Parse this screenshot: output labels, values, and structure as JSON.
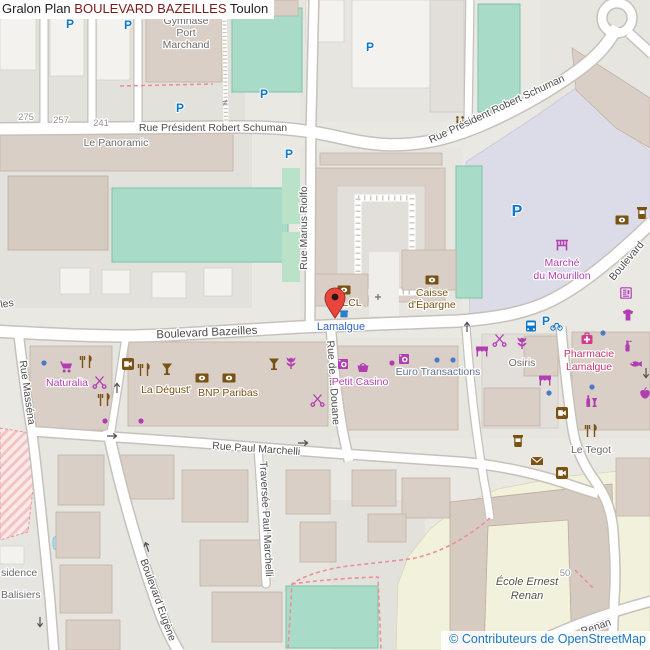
{
  "title": {
    "part1": "Gralon Plan",
    "highlight": "BOULEVARD BAZEILLES",
    "part2": "Toulon"
  },
  "attribution": "© Contributeurs de OpenStreetMap",
  "colors": {
    "title_highlight": "#7c1a1a",
    "attribution_blue": "#1d79c4",
    "street_label": "#4d4d4d",
    "shop_label": "#b23db2",
    "amenity_label": "#7a5214",
    "transport_blue": "#0b77cc",
    "bus_stop_label": "#3465c8",
    "pharmacy_label": "#c5356b",
    "office_label": "#5f6f8a",
    "marker_red": "#e8453c",
    "pedestrian_area": "#dcdce8",
    "pitch_green": "#a8dcc8",
    "school_area": "#f2f1dc",
    "building": "#d9cfc6"
  },
  "streets": {
    "schuman1": "Rue Président Robert Schuman",
    "schuman2": "Rue Président Robert Schuman",
    "bazeilles": "Boulevard Bazeilles",
    "bazeilles_frag": "les",
    "boulevard_frag": "Boulevard",
    "riolfo": "Rue Marius Riolfo",
    "douane": "Rue de la Douane",
    "massena": "Rue Masséna",
    "marchelli": "Rue Paul Marchelli",
    "traversee": "Traversée Paul Marchelli",
    "eugene": "Boulevard Eugène",
    "renan_frag": "Renan"
  },
  "places": {
    "gymnase_l1": "Gymnase",
    "gymnase_l2": "Port",
    "gymnase_l3": "Marchand",
    "panoramic": "Le Panoramic",
    "marche_l1": "Marché",
    "marche_l2": "du Mourillon",
    "caisse_l1": "Caisse",
    "caisse_l2": "d'Épargne",
    "lcl": "LCL",
    "lamalgue_stop": "Lamalgue",
    "naturalia": "Naturalia",
    "degust": "La Dégust'",
    "bnp": "BNP Paribas",
    "petit_casino": "Petit Casino",
    "euro_trans": "Euro Transactions",
    "osiris": "Osiris",
    "pharmacie_l1": "Pharmacie",
    "pharmacie_l2": "Lamalgue",
    "tegot": "Le Tegot",
    "ecole_l1": "École Ernest",
    "ecole_l2": "Renan",
    "residence_frag1": "sidence",
    "residence_frag2": "Balisiers"
  },
  "house_numbers": {
    "n275": "275",
    "n257": "257",
    "n241": "241",
    "n50": "50"
  },
  "symbols": {
    "parking": "P",
    "gate": "≠"
  }
}
